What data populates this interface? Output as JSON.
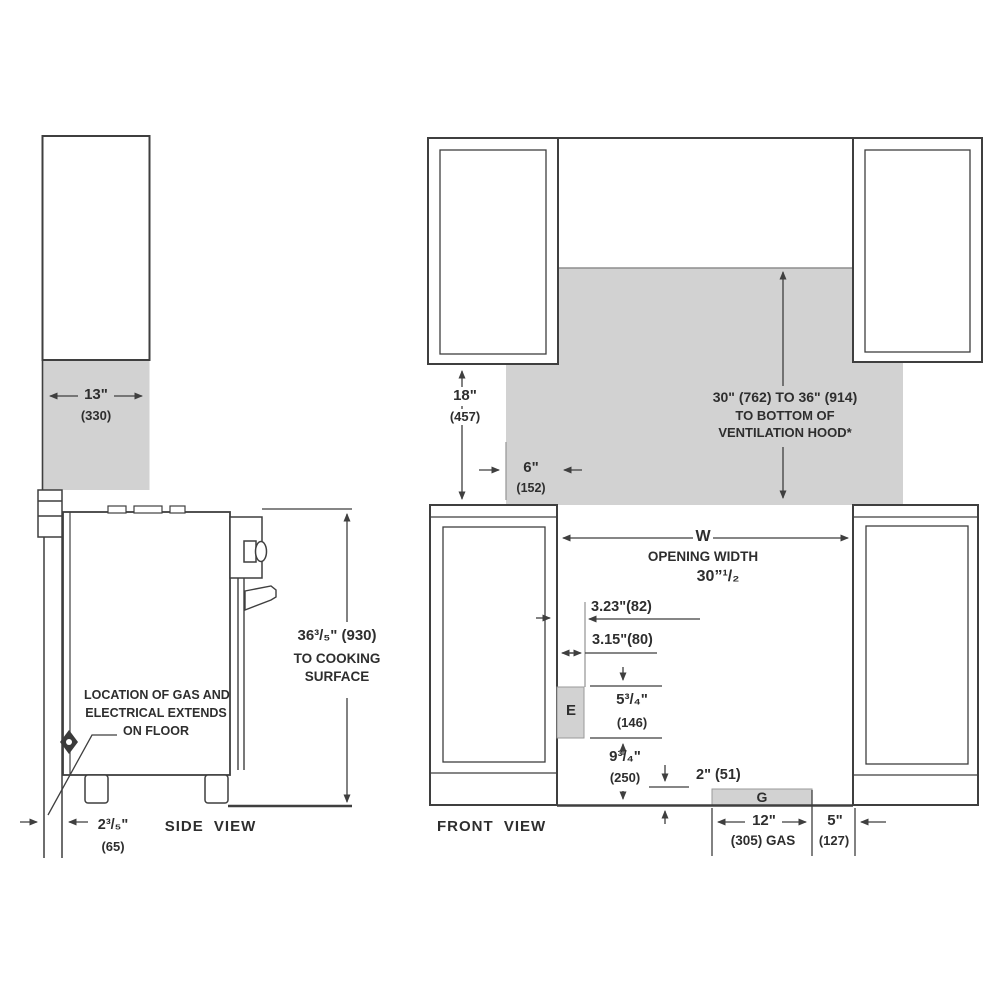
{
  "colors": {
    "line": "#3f3f3f",
    "clearance_gray": "#d2d2d2",
    "text": "#2e2e2e"
  },
  "side": {
    "label": "SIDE VIEW",
    "dim13_in": "13\"",
    "dim13_mm": "(330)",
    "height_line1": "36³/₅\" (930)",
    "height_line2": "TO COOKING",
    "height_line3": "SURFACE",
    "gas_note_l1": "LOCATION OF GAS AND",
    "gas_note_l2": "ELECTRICAL EXTENDS",
    "gas_note_l3": "ON FLOOR",
    "gap_in": "2³/₅\"",
    "gap_mm": "(65)"
  },
  "front": {
    "label": "FRONT VIEW",
    "d18_in": "18\"",
    "d18_mm": "(457)",
    "d6_in": "6\"",
    "d6_mm": "(152)",
    "hood_l1": "30\" (762) TO 36\" (914)",
    "hood_l2": "TO BOTTOM OF",
    "hood_l3": "VENTILATION HOOD*",
    "w_letter": "W",
    "w_label": "OPENING WIDTH",
    "w_value": "30”¹/₂",
    "d323": "3.23\"(82)",
    "d315": "3.15\"(80)",
    "e_letter": "E",
    "d534_in": "5³/₄\"",
    "d534_mm": "(146)",
    "d934_in": "9³/₄\"",
    "d934_mm": "(250)",
    "d2_in": "2\" (51)",
    "g_letter": "G",
    "d12_in": "12\"",
    "d12_mm": "(305) GAS",
    "d5_in": "5\"",
    "d5_mm": "(127)"
  }
}
